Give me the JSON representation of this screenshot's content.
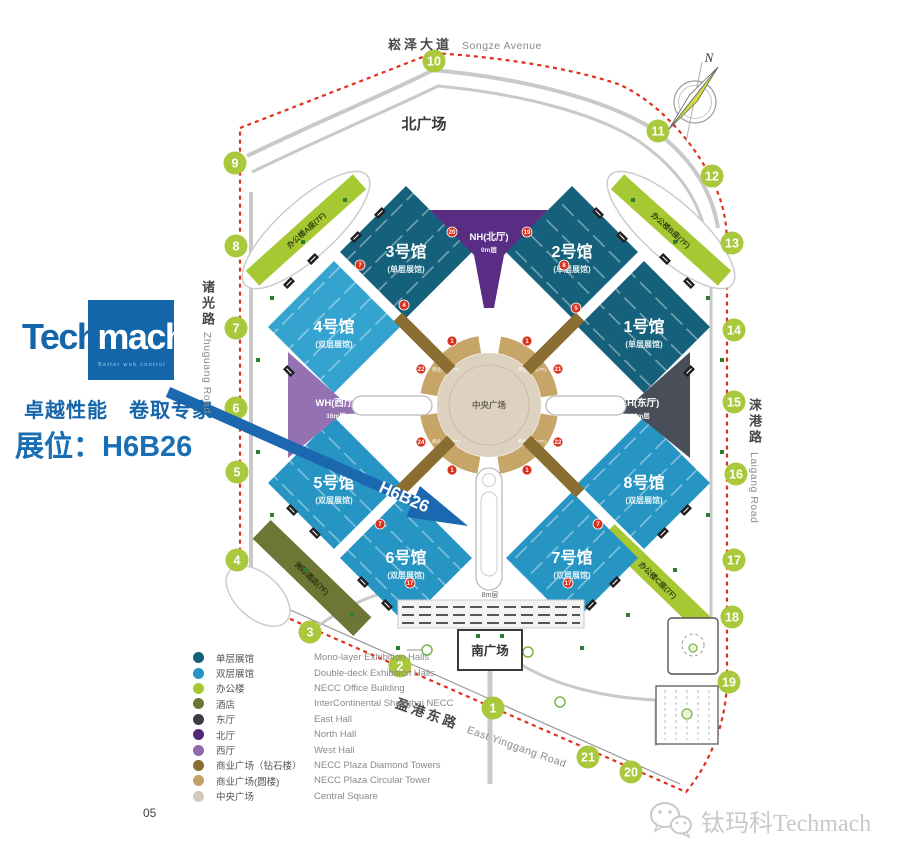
{
  "branding": {
    "logo_prefix": "Tech",
    "logo_suffix": "mach",
    "logo_tagline": "Better web control",
    "slogan": "卓越性能　卷取专家",
    "booth": "展位：H6B26",
    "arrow_label": "H6B26"
  },
  "page_number": "05",
  "watermark": {
    "text": "钛玛科Techmach",
    "icon": "wechat-icon"
  },
  "compass_label": "N",
  "legend": {
    "items": [
      {
        "zh": "单层展馆",
        "en": "Mono-layer Exhibition Halls",
        "color": "#15607a"
      },
      {
        "zh": "双层展馆",
        "en": "Double-deck Exhibition Halls",
        "color": "#2795c3"
      },
      {
        "zh": "办公楼",
        "en": "NECC Office Building",
        "color": "#a6c832"
      },
      {
        "zh": "酒店",
        "en": "InterContinental Shanghai NECC",
        "color": "#6d7634"
      },
      {
        "zh": "东厅",
        "en": "East Hall",
        "color": "#3a3d46"
      },
      {
        "zh": "北厅",
        "en": "North Hall",
        "color": "#542a78"
      },
      {
        "zh": "西厅",
        "en": "West Hall",
        "color": "#9068ac"
      },
      {
        "zh": "商业广场（钻石楼）",
        "en": "NECC Plaza Diamond Towers",
        "color": "#8a6d30"
      },
      {
        "zh": "商业广场(圆楼)",
        "en": "NECC Plaza Circular Tower",
        "color": "#c2a268"
      },
      {
        "zh": "中央广场",
        "en": "Central Square",
        "color": "#d2cabc"
      }
    ]
  },
  "map": {
    "road_labels": {
      "songze_zh": "崧泽大道",
      "songze_en": "Songze Avenue",
      "zhuguang_zh": "诸光路",
      "zhuguang_en": "Zhuguang Road",
      "laigang_zh": "涞港路",
      "laigang_en": "Laigang Road",
      "yinggang_zh": "盈港东路",
      "yinggang_en": "East Yinggang Road"
    },
    "labels": {
      "north_plaza": "北广场",
      "south_plaza": "南广场",
      "central_square": "中央广场",
      "platform": "8m层"
    },
    "plaza_ring_label": "商业广场(7F)",
    "halls": [
      {
        "name": "3号馆",
        "sub": "(单层展馆)"
      },
      {
        "name": "2号馆",
        "sub": "(单层展馆)"
      },
      {
        "name": "4号馆",
        "sub": "(双层展馆)"
      },
      {
        "name": "1号馆",
        "sub": "(单层展馆)"
      },
      {
        "name": "5号馆",
        "sub": "(双层展馆)"
      },
      {
        "name": "8号馆",
        "sub": "(双层展馆)"
      },
      {
        "name": "6号馆",
        "sub": "(双层展馆)"
      },
      {
        "name": "7号馆",
        "sub": "(双层展馆)"
      }
    ],
    "lobbies": [
      {
        "name": "NH(北厅)",
        "level": "0m层"
      },
      {
        "name": "WH(西厅)",
        "level": "16m层"
      },
      {
        "name": "EH(东厅)",
        "level": "16m层"
      }
    ],
    "offices": [
      "办公楼A座(7F)",
      "办公楼B座(7F)",
      "办公楼C座(7F)"
    ],
    "hotel_label": "洲际酒店(7F)",
    "colors": {
      "gate": "#a9c83b",
      "badge": "#d8321f",
      "dock": "#1e1e1e",
      "tree": "#2e7d32",
      "boundary": "#e0301e"
    },
    "gates": [
      {
        "n": "1",
        "x": 493,
        "y": 708
      },
      {
        "n": "2",
        "x": 400,
        "y": 666
      },
      {
        "n": "3",
        "x": 310,
        "y": 632
      },
      {
        "n": "4",
        "x": 237,
        "y": 560
      },
      {
        "n": "5",
        "x": 237,
        "y": 472
      },
      {
        "n": "6",
        "x": 236,
        "y": 408
      },
      {
        "n": "7",
        "x": 236,
        "y": 328
      },
      {
        "n": "8",
        "x": 236,
        "y": 246
      },
      {
        "n": "9",
        "x": 235,
        "y": 163
      },
      {
        "n": "10",
        "x": 434,
        "y": 61
      },
      {
        "n": "11",
        "x": 658,
        "y": 131
      },
      {
        "n": "12",
        "x": 712,
        "y": 176
      },
      {
        "n": "13",
        "x": 732,
        "y": 243
      },
      {
        "n": "14",
        "x": 734,
        "y": 330
      },
      {
        "n": "15",
        "x": 734,
        "y": 402
      },
      {
        "n": "16",
        "x": 736,
        "y": 474
      },
      {
        "n": "17",
        "x": 734,
        "y": 560
      },
      {
        "n": "18",
        "x": 732,
        "y": 617
      },
      {
        "n": "19",
        "x": 729,
        "y": 682
      },
      {
        "n": "20",
        "x": 631,
        "y": 772
      },
      {
        "n": "21",
        "x": 588,
        "y": 757
      }
    ],
    "badges": [
      {
        "n": "7",
        "x": 360,
        "y": 265
      },
      {
        "n": "4",
        "x": 404,
        "y": 305
      },
      {
        "n": "20",
        "x": 452,
        "y": 232
      },
      {
        "n": "19",
        "x": 527,
        "y": 232
      },
      {
        "n": "8",
        "x": 564,
        "y": 265
      },
      {
        "n": "5",
        "x": 576,
        "y": 308
      },
      {
        "n": "1",
        "x": 452,
        "y": 341
      },
      {
        "n": "1",
        "x": 527,
        "y": 341
      },
      {
        "n": "22",
        "x": 421,
        "y": 369
      },
      {
        "n": "21",
        "x": 558,
        "y": 369
      },
      {
        "n": "24",
        "x": 421,
        "y": 442
      },
      {
        "n": "22",
        "x": 558,
        "y": 442
      },
      {
        "n": "1",
        "x": 452,
        "y": 470
      },
      {
        "n": "1",
        "x": 527,
        "y": 470
      },
      {
        "n": "7",
        "x": 380,
        "y": 524
      },
      {
        "n": "7",
        "x": 598,
        "y": 524
      },
      {
        "n": "17",
        "x": 410,
        "y": 583
      },
      {
        "n": "17",
        "x": 568,
        "y": 583
      }
    ],
    "deco": {
      "docks": [
        [
          356,
          237,
          -45
        ],
        [
          380,
          213,
          -45
        ],
        [
          598,
          213,
          45
        ],
        [
          622,
          237,
          45
        ],
        [
          289,
          283,
          -45
        ],
        [
          313,
          259,
          -45
        ],
        [
          289,
          371,
          45
        ],
        [
          665,
          259,
          45
        ],
        [
          689,
          283,
          45
        ],
        [
          689,
          371,
          -45
        ],
        [
          292,
          510,
          45
        ],
        [
          315,
          533,
          45
        ],
        [
          663,
          533,
          -45
        ],
        [
          686,
          510,
          -45
        ],
        [
          363,
          582,
          45
        ],
        [
          387,
          605,
          45
        ],
        [
          591,
          605,
          -45
        ],
        [
          615,
          582,
          -45
        ]
      ],
      "trees": [
        [
          345,
          200
        ],
        [
          303,
          242
        ],
        [
          272,
          298
        ],
        [
          258,
          360
        ],
        [
          258,
          452
        ],
        [
          272,
          515
        ],
        [
          305,
          570
        ],
        [
          352,
          615
        ],
        [
          398,
          648
        ],
        [
          478,
          636
        ],
        [
          502,
          636
        ],
        [
          582,
          648
        ],
        [
          628,
          615
        ],
        [
          675,
          570
        ],
        [
          708,
          515
        ],
        [
          722,
          452
        ],
        [
          722,
          360
        ],
        [
          708,
          298
        ],
        [
          675,
          242
        ],
        [
          633,
          200
        ]
      ]
    }
  }
}
